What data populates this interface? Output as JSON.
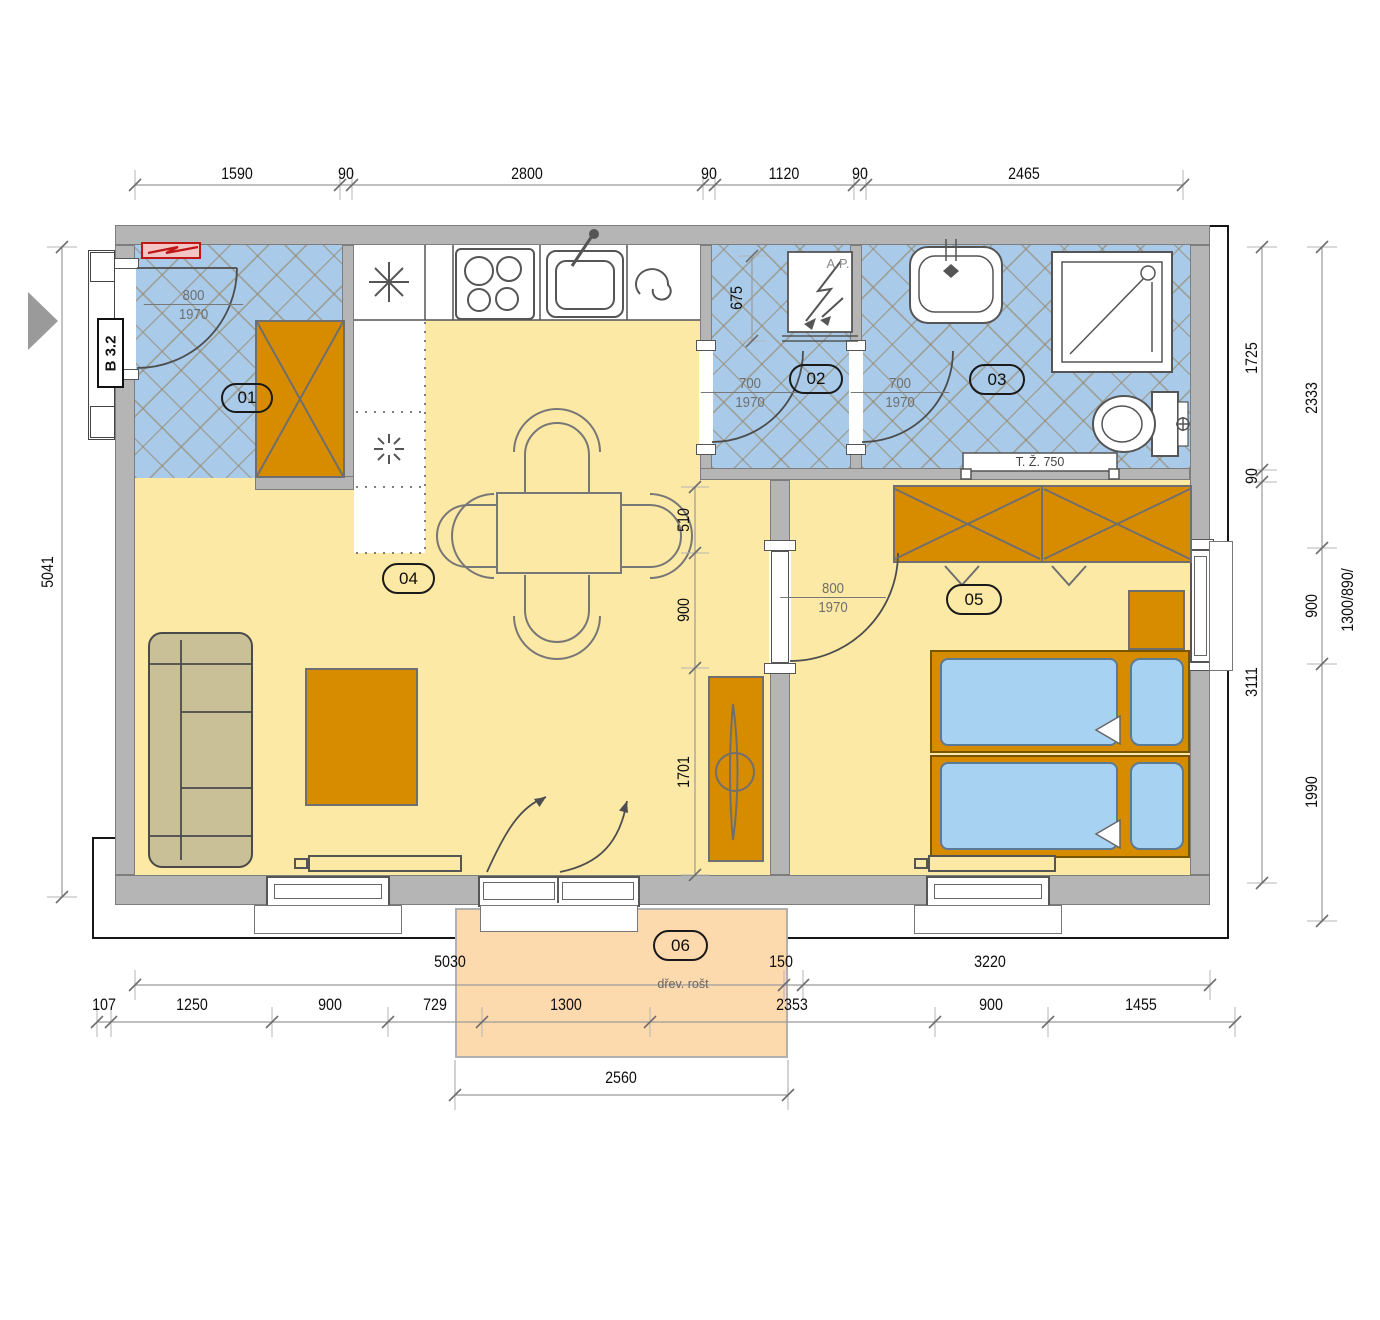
{
  "palette": {
    "floor": "#fce9a6",
    "tile": "#a9cbe9",
    "wall": "#b5b5b5",
    "furniture": "#d78c00",
    "bed": "#a8d2f2",
    "terrace": "#fdd9ae",
    "alert": "#cc1111"
  },
  "rooms": {
    "r01": "01",
    "r02": "02",
    "r03": "03",
    "r04": "04",
    "r05": "05",
    "r06": "06"
  },
  "labels": {
    "entrance": "B 3.2",
    "boiler": "A.P.",
    "towel_radiator": "T. Ž. 750",
    "terrace_note": "dřev. rošt",
    "window_spec": "1300/890/"
  },
  "doors": {
    "entry": {
      "w": "800",
      "h": "1970"
    },
    "wc": {
      "w": "700",
      "h": "1970"
    },
    "bath": {
      "w": "700",
      "h": "1970"
    },
    "bedroom": {
      "w": "800",
      "h": "1970"
    }
  },
  "dims": {
    "top": [
      "1590",
      "90",
      "2800",
      "90",
      "1120",
      "90",
      "2465"
    ],
    "left": [
      "5041"
    ],
    "right_inner": [
      "1725",
      "90",
      "3111"
    ],
    "right_outer": [
      "2333",
      "900",
      "1990"
    ],
    "bottom1": [
      "5030",
      "150",
      "3220"
    ],
    "bottom2": [
      "107",
      "1250",
      "900",
      "729",
      "1300",
      "2353",
      "900",
      "1455"
    ],
    "bottom3": [
      "2560"
    ],
    "living": [
      "510",
      "900",
      "1701"
    ],
    "wc_room": [
      "675"
    ]
  }
}
